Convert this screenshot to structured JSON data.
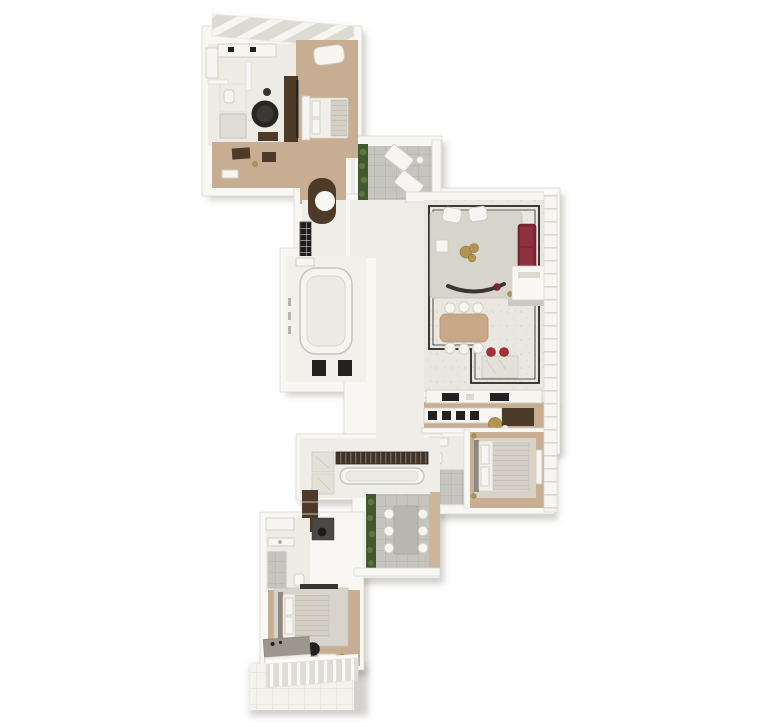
{
  "scene": {
    "type": "architectural-floor-plan",
    "style": "3d-axonometric-render",
    "background": "#ffffff",
    "has_text_labels": false
  },
  "palette": {
    "wall": "#f8f7f4",
    "wall_edge": "#d6d3cb",
    "floor_tan": "#c7ad91",
    "floor_marble": "#edebe4",
    "floor_hall": "#efede7",
    "border_inlay": "#262420",
    "rug": "#d7d4cc",
    "sofa_maroon": "#7c2733",
    "stool_red": "#a82f38",
    "wood_table": "#c8a887",
    "brass": "#b29350",
    "tub_black": "#262524",
    "plant_green": "#41592f",
    "plant_green_light": "#5c7742",
    "terrace_tile": "#c6c4be",
    "dark_wood": "#4e3a28",
    "appliance_black": "#232220",
    "bed_white": "#f1efe9",
    "duvet_gray": "#d4cfc4",
    "headboard_gray": "#8d8880",
    "glass": "#dcdbd3",
    "shadow": "rgba(92,86,76,0.28)"
  },
  "rooms": [
    {
      "id": "primary-suite",
      "area": "top-left",
      "features": [
        "primary-bedroom",
        "primary-bathroom",
        "walk-in-closet"
      ],
      "furniture": [
        "king-bed",
        "chaise-lounge",
        "media-wall",
        "round-bathtub",
        "double-vanity",
        "shower",
        "toilet",
        "dressers",
        "wardrobe"
      ]
    },
    {
      "id": "entry-foyer",
      "area": "upper-middle",
      "furniture": [
        "curved-wood-niche",
        "open-shelf-unit"
      ]
    },
    {
      "id": "upper-terrace",
      "area": "upper-middle-right",
      "furniture": [
        "sun-lounger",
        "sun-lounger",
        "planter"
      ]
    },
    {
      "id": "great-room",
      "area": "right",
      "features": [
        "living-room",
        "dining-area",
        "breakfast-bar"
      ],
      "furniture": [
        "sofa",
        "armchair",
        "armchair",
        "coffee-table",
        "side-table",
        "curved-bench",
        "fireplace-volume",
        "area-rug",
        "dining-table",
        "dining-chairs",
        "breakfast-bar",
        "bar-stools"
      ]
    },
    {
      "id": "kitchen",
      "area": "right-middle",
      "furniture": [
        "back-counter",
        "cooktop",
        "oven",
        "island-cabinets",
        "bistro-table",
        "wine-bar"
      ]
    },
    {
      "id": "bedroom-2",
      "area": "lower-right",
      "features": [
        "ensuite-bathroom"
      ],
      "furniture": [
        "bed",
        "rug",
        "vanity",
        "shower",
        "toilet",
        "wall-sconces",
        "bench"
      ]
    },
    {
      "id": "dressing-room",
      "area": "middle-left",
      "furniture": [
        "closet-island",
        "laundry-units"
      ]
    },
    {
      "id": "wardrobe-corridor",
      "area": "lower-middle",
      "furniture": [
        "hanging-rail",
        "dressing-island",
        "linen-cabinets",
        "tall-cabinet",
        "desk",
        "desk-chair"
      ]
    },
    {
      "id": "lower-terrace",
      "area": "lower-middle",
      "furniture": [
        "outdoor-dining-table",
        "outdoor-chairs",
        "planter"
      ]
    },
    {
      "id": "bedroom-3",
      "area": "bottom-left",
      "features": [
        "ensuite-bathroom"
      ],
      "furniture": [
        "bed",
        "rug",
        "media-shelf",
        "pouf",
        "nightstand",
        "dresser",
        "vanity",
        "shower",
        "toilet",
        "window-wall"
      ]
    }
  ]
}
